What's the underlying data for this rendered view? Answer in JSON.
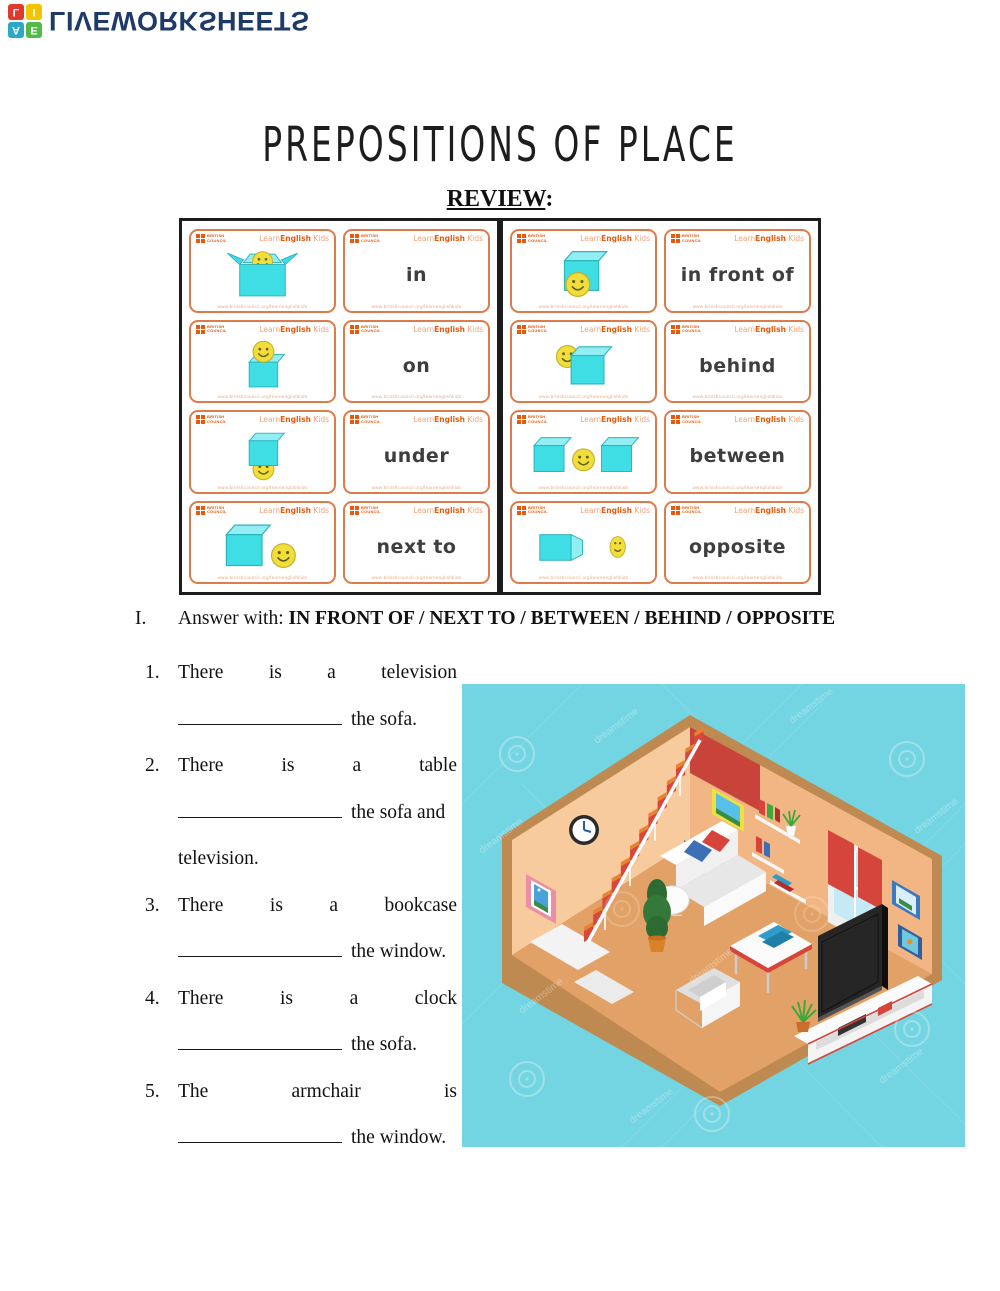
{
  "palette": {
    "navy": "#1E3A68",
    "logo-a": "#2BA8C4",
    "logo-e": "#53B948",
    "logo-l": "#E2392C",
    "logo-i": "#F2C500",
    "card-orange": "#DE7B4B",
    "bc-orange": "#E8590C",
    "bc-orange-light": "#F2A379",
    "url-orange": "#EAAA80",
    "cyan": "#3FDEE5",
    "cyan-light": "#93EEF2",
    "cyan-stroke": "#2BB3BE",
    "smiley": "#F2DE3B",
    "word-gray": "#3E3E3E",
    "teal-bg": "#74D5E2",
    "wall-left": "#F8CB9E",
    "wall-right": "#F1B683",
    "floor": "#E2A267",
    "floor-edge": "#BE8A52",
    "stair-red": "#D8473B",
    "stair-orange": "#E8842F",
    "stairwell-red": "#C8433A",
    "accent-red": "#D6453C",
    "pillow-blue": "#3D6FB5"
  },
  "logo": {
    "text": "LIVEWORKSHEETS",
    "squares": [
      {
        "letter": "A"
      },
      {
        "letter": "E"
      },
      {
        "letter": "L"
      },
      {
        "letter": "I"
      }
    ]
  },
  "title": "PREPOSITIONS OF PLACE",
  "review_heading": "REVIEW",
  "review_colon": ":",
  "flashcards": {
    "brand": {
      "council_line1": "BRITISH",
      "council_line2": "COUNCIL",
      "learn": "Learn",
      "english": "English",
      "kids": " Kids",
      "url": "www.britishcouncil.org/learnenglishkids"
    },
    "left": [
      {
        "word": "in",
        "image": "smiley-inside-open-box"
      },
      {
        "word": "on",
        "image": "smiley-on-top-of-box"
      },
      {
        "word": "under",
        "image": "smiley-under-box"
      },
      {
        "word": "next to",
        "image": "smiley-next-to-box"
      }
    ],
    "right": [
      {
        "word": "in front of",
        "image": "smiley-in-front-of-box"
      },
      {
        "word": "behind",
        "image": "smiley-behind-box"
      },
      {
        "word": "between",
        "image": "smiley-between-two-boxes"
      },
      {
        "word": "opposite",
        "image": "smiley-opposite-box"
      }
    ]
  },
  "section": {
    "numeral": "I.",
    "prompt": "Answer with: ",
    "options": "IN FRONT OF / NEXT TO / BETWEEN / BEHIND / OPPOSITE"
  },
  "questions": [
    {
      "number": "1.",
      "line1": "There is a television",
      "tail": "the sofa."
    },
    {
      "number": "2.",
      "line1": "There is a table",
      "tail": "the sofa and",
      "line3": "television."
    },
    {
      "number": "3.",
      "line1": "There is a bookcase",
      "tail": "the window."
    },
    {
      "number": "4.",
      "line1": "There is a clock",
      "tail": "the sofa."
    },
    {
      "number": "5.",
      "line1": "The armchair is",
      "tail": "the window."
    }
  ],
  "illustration": {
    "scene": "isometric-living-room",
    "watermark": "dreamstime"
  }
}
